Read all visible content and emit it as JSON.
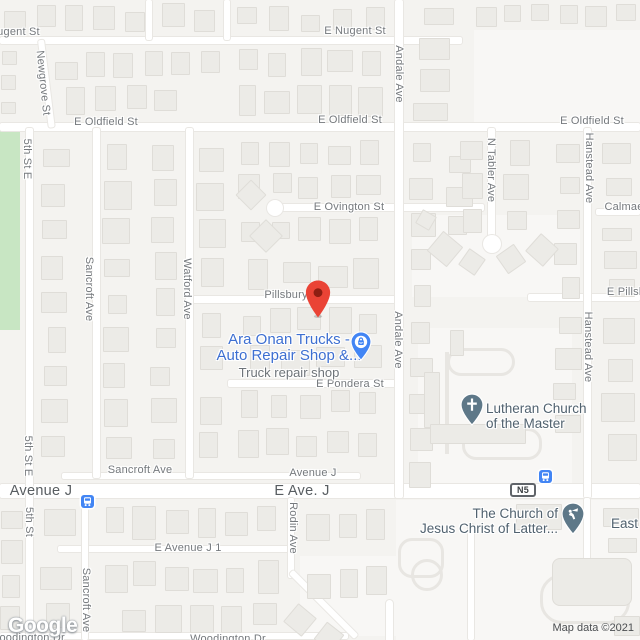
{
  "map": {
    "watermark": "Google",
    "attribution": "Map data ©2021",
    "route_shield": {
      "text": "N5",
      "x": 523,
      "y": 490
    },
    "colors": {
      "destination_pin_red": "#EA4335",
      "destination_pin_hole": "#8E1E12",
      "business_label_blue": "#3D6FD1",
      "shop_pin_blue": "#4285F4",
      "church_pin_slate": "#5E7888",
      "transit_blue": "#4285F4",
      "park_green": "#C8E6C3",
      "road_white": "#FFFFFF"
    },
    "destination_pin": {
      "x": 318,
      "y": 318
    },
    "street_labels": [
      {
        "t": "E Nugent St",
        "x": 9,
        "y": 32,
        "r": 0,
        "s": "sm"
      },
      {
        "t": "E Nugent St",
        "x": 355,
        "y": 31,
        "r": 0,
        "s": "sm"
      },
      {
        "t": "Newgrove St",
        "x": 43,
        "y": 83,
        "r": 84,
        "s": "sm"
      },
      {
        "t": "E Oldfield St",
        "x": 106,
        "y": 122,
        "r": 0,
        "s": "sm"
      },
      {
        "t": "E Oldfield St",
        "x": 350,
        "y": 120,
        "r": 0,
        "s": "sm"
      },
      {
        "t": "E Oldfield St",
        "x": 592,
        "y": 121,
        "r": 0,
        "s": "sm"
      },
      {
        "t": "5th St E",
        "x": 27,
        "y": 159,
        "r": 90,
        "s": "sm"
      },
      {
        "t": "Andale Ave",
        "x": 399,
        "y": 74,
        "r": 90,
        "s": "sm"
      },
      {
        "t": "N Tabler Ave",
        "x": 491,
        "y": 170,
        "r": 90,
        "s": "sm"
      },
      {
        "t": "Hanstead Ave",
        "x": 589,
        "y": 168,
        "r": 90,
        "s": "sm"
      },
      {
        "t": "E Ovington St",
        "x": 349,
        "y": 207,
        "r": 0,
        "s": "sm"
      },
      {
        "t": "Calmae",
        "x": 624,
        "y": 207,
        "r": 0,
        "s": "sm"
      },
      {
        "t": "Sancroft Ave",
        "x": 89,
        "y": 289,
        "r": 90,
        "s": "sm"
      },
      {
        "t": "Watford Ave",
        "x": 187,
        "y": 289,
        "r": 90,
        "s": "sm"
      },
      {
        "t": "Pillsbury",
        "x": 286,
        "y": 295,
        "r": 0,
        "s": "sm"
      },
      {
        "t": "E Pillsbury",
        "x": 634,
        "y": 292,
        "r": 0,
        "s": "sm"
      },
      {
        "t": "Andale Ave",
        "x": 398,
        "y": 340,
        "r": 90,
        "s": "sm"
      },
      {
        "t": "Hanstead Ave",
        "x": 588,
        "y": 347,
        "r": 90,
        "s": "sm"
      },
      {
        "t": "E Pondera St",
        "x": 350,
        "y": 384,
        "r": 0,
        "s": "sm"
      },
      {
        "t": "Sancroft Ave",
        "x": 140,
        "y": 470,
        "r": 0,
        "s": "sm"
      },
      {
        "t": "Avenue J",
        "x": 313,
        "y": 473,
        "r": 0,
        "s": "sm"
      },
      {
        "t": "Avenue J",
        "x": 41,
        "y": 491,
        "r": 0,
        "s": "lg"
      },
      {
        "t": "E Ave. J",
        "x": 302,
        "y": 491,
        "r": 0,
        "s": "lg"
      },
      {
        "t": "5th St E",
        "x": 28,
        "y": 456,
        "r": 90,
        "s": "sm"
      },
      {
        "t": "5th St",
        "x": 29,
        "y": 522,
        "r": 90,
        "s": "sm"
      },
      {
        "t": "Rodin Ave",
        "x": 293,
        "y": 528,
        "r": 90,
        "s": "sm"
      },
      {
        "t": "E Avenue J 1",
        "x": 188,
        "y": 548,
        "r": 0,
        "s": "sm"
      },
      {
        "t": "Sancroft Ave",
        "x": 86,
        "y": 600,
        "r": 90,
        "s": "sm"
      },
      {
        "t": "Woodington Dr",
        "x": 27,
        "y": 638,
        "r": 0,
        "s": "sm"
      },
      {
        "t": "Woodington Dr",
        "x": 228,
        "y": 639,
        "r": 0,
        "s": "sm"
      }
    ],
    "pois": {
      "business": {
        "line1": "Ara Onan Trucks -",
        "line2": "Auto Repair Shop &...",
        "subtitle": "Truck repair shop"
      },
      "lutheran": {
        "line1": "Lutheran Church",
        "line2": "of the Master"
      },
      "lds": {
        "line1": "The Church of",
        "line2": "Jesus Christ of Latter..."
      },
      "east": "East"
    },
    "transit_stops": [
      {
        "x": 88,
        "y": 502
      },
      {
        "x": 546,
        "y": 477
      }
    ]
  }
}
